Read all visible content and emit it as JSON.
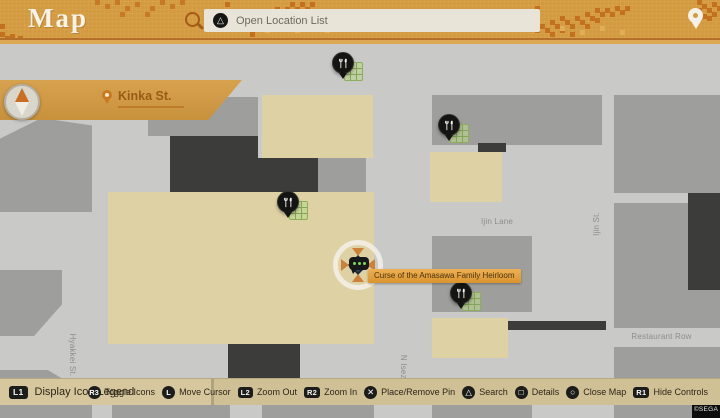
{
  "header": {
    "title": "Map",
    "search_button": {
      "glyph": "△",
      "label": "Open Location List"
    }
  },
  "current_location": {
    "name": "Kinka St."
  },
  "map": {
    "street_labels": [
      {
        "text": "Ijin Lane",
        "x": 467,
        "y": 177,
        "w": 60,
        "rotate": 0
      },
      {
        "text": "Ijin Alley",
        "x": 472,
        "y": 337,
        "w": 60,
        "rotate": 0
      },
      {
        "text": "Restaurant Row",
        "x": 619,
        "y": 292,
        "w": 85,
        "rotate": 0
      },
      {
        "text": "Hyakkei St.",
        "x": 42,
        "y": 310,
        "w": 60,
        "rotate": 90
      },
      {
        "text": "N Isezaki Rd.",
        "x": 371,
        "y": 335,
        "w": 64,
        "rotate": 90
      },
      {
        "text": "Ijin St.",
        "x": 572,
        "y": 179,
        "w": 50,
        "rotate": -90
      }
    ],
    "markers": [
      {
        "type": "restaurant-pin",
        "x": 332,
        "y": 52,
        "shop_grid": true
      },
      {
        "type": "restaurant-pin",
        "x": 438,
        "y": 114,
        "shop_grid": true
      },
      {
        "type": "restaurant-pin",
        "x": 277,
        "y": 191,
        "shop_grid": true
      },
      {
        "type": "restaurant-pin",
        "x": 450,
        "y": 282,
        "shop_grid": true
      }
    ],
    "cursor_tooltip": "Curse of the Amasawa Family Heirloom",
    "copyright": "©SEGA"
  },
  "controls": {
    "legend": {
      "button": "L1",
      "label": "Display Icon Legend"
    },
    "items": [
      {
        "button": "R3",
        "label": "Toggle Icons"
      },
      {
        "button": "L",
        "label": "Move Cursor"
      },
      {
        "button": "L2",
        "label": "Zoom Out"
      },
      {
        "button": "R2",
        "label": "Zoom In"
      },
      {
        "button": "✕",
        "label": "Place/Remove Pin"
      },
      {
        "button": "△",
        "label": "Search"
      },
      {
        "button": "□",
        "label": "Details"
      },
      {
        "button": "○",
        "label": "Close Map"
      },
      {
        "button": "R1",
        "label": "Hide Controls"
      }
    ]
  },
  "colors": {
    "header_orange": "#d49a40",
    "mosaic_orange": "#c3701f",
    "map_street": "#c9c9c7",
    "building_gray": "#9e9e9c",
    "building_dark": "#3c3c3a",
    "building_tan": "#ded2a4",
    "bottom_bar": "#d0c096",
    "tooltip_orange": "#e0a03c",
    "bubble_green": "#7ed957"
  }
}
